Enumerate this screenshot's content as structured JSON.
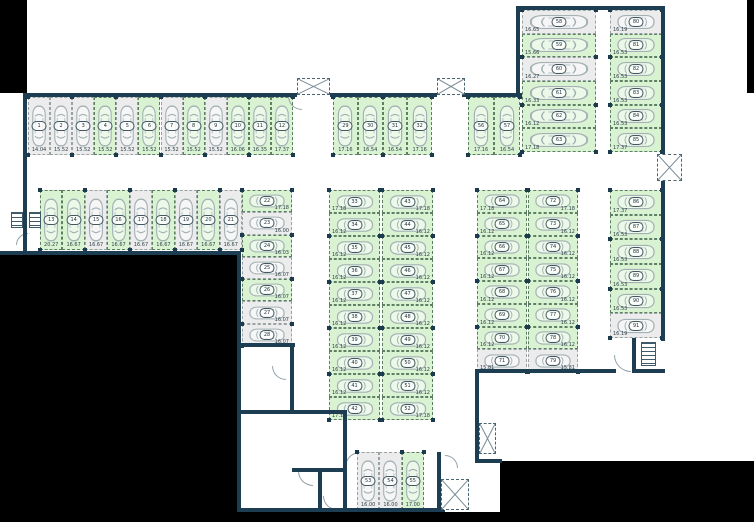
{
  "plan": {
    "name": "parking-garage-floor-plan",
    "colors": {
      "wall": "#1d3d52",
      "exterior": "#000000",
      "stall_free_fill": "#d9f2d2",
      "stall_free_border": "#5d7f63",
      "stall_occupied_fill": "#ececec",
      "stall_occupied_border": "#99a2a5",
      "car_outline": "#a3b1b4",
      "label_text": "#2e3f4a",
      "corner_marker": "#1c3a4e"
    },
    "groups": [
      {
        "id": "row-1-12",
        "dir": "row",
        "x": 28,
        "y": 97,
        "w": 265,
        "h": 58,
        "label": "bottom",
        "stalls": [
          {
            "n": "1",
            "m": "14.04",
            "s": "occ"
          },
          {
            "n": "2",
            "m": "15.52",
            "s": "occ"
          },
          {
            "n": "3",
            "m": "15.52",
            "s": "occ"
          },
          {
            "n": "4",
            "m": "15.52",
            "s": "free"
          },
          {
            "n": "5",
            "m": "15.52",
            "s": "occ"
          },
          {
            "n": "6",
            "m": "15.52",
            "s": "free"
          },
          {
            "n": "7",
            "m": "15.52",
            "s": "occ"
          },
          {
            "n": "8",
            "m": "15.52",
            "s": "free"
          },
          {
            "n": "9",
            "m": "15.52",
            "s": "occ"
          },
          {
            "n": "10",
            "m": "16.06",
            "s": "free"
          },
          {
            "n": "11",
            "m": "16.35",
            "s": "free"
          },
          {
            "n": "12",
            "m": "17.37",
            "s": "free"
          }
        ]
      },
      {
        "id": "row-13-21",
        "dir": "row",
        "x": 40,
        "y": 190,
        "w": 202,
        "h": 60,
        "label": "bottom",
        "stalls": [
          {
            "n": "13",
            "m": "20.27",
            "s": "free"
          },
          {
            "n": "14",
            "m": "16.67",
            "s": "free"
          },
          {
            "n": "15",
            "m": "16.67",
            "s": "occ"
          },
          {
            "n": "16",
            "m": "16.67",
            "s": "free"
          },
          {
            "n": "17",
            "m": "16.67",
            "s": "occ"
          },
          {
            "n": "18",
            "m": "16.67",
            "s": "free"
          },
          {
            "n": "19",
            "m": "16.67",
            "s": "occ"
          },
          {
            "n": "20",
            "m": "16.67",
            "s": "free"
          },
          {
            "n": "21",
            "m": "16.67",
            "s": "occ"
          }
        ]
      },
      {
        "id": "col-22-28",
        "dir": "col",
        "x": 242,
        "y": 190,
        "w": 50,
        "h": 156,
        "label": "right",
        "stalls": [
          {
            "n": "22",
            "m": "17.18",
            "s": "free"
          },
          {
            "n": "23",
            "m": "16.00",
            "s": "occ"
          },
          {
            "n": "24",
            "m": "16.03",
            "s": "free"
          },
          {
            "n": "25",
            "m": "16.07",
            "s": "occ"
          },
          {
            "n": "26",
            "m": "16.07",
            "s": "free"
          },
          {
            "n": "27",
            "m": "16.07",
            "s": "occ"
          },
          {
            "n": "28",
            "m": "16.07",
            "s": "occ"
          }
        ]
      },
      {
        "id": "row-29-32",
        "dir": "row",
        "x": 333,
        "y": 97,
        "w": 99,
        "h": 58,
        "label": "bottom",
        "stalls": [
          {
            "n": "29",
            "m": "17.16",
            "s": "free"
          },
          {
            "n": "30",
            "m": "16.54",
            "s": "free"
          },
          {
            "n": "31",
            "m": "16.54",
            "s": "free"
          },
          {
            "n": "32",
            "m": "17.16",
            "s": "free"
          }
        ]
      },
      {
        "id": "col-33-42",
        "dir": "col",
        "x": 329,
        "y": 190,
        "w": 51,
        "h": 230,
        "label": "left",
        "stalls": [
          {
            "n": "33",
            "m": "17.18",
            "s": "free"
          },
          {
            "n": "34",
            "m": "16.12",
            "s": "free"
          },
          {
            "n": "35",
            "m": "16.12",
            "s": "free"
          },
          {
            "n": "36",
            "m": "16.12",
            "s": "free"
          },
          {
            "n": "37",
            "m": "16.12",
            "s": "free"
          },
          {
            "n": "38",
            "m": "16.12",
            "s": "free"
          },
          {
            "n": "39",
            "m": "16.12",
            "s": "free"
          },
          {
            "n": "40",
            "m": "16.12",
            "s": "free"
          },
          {
            "n": "41",
            "m": "16.12",
            "s": "free"
          },
          {
            "n": "42",
            "m": "17.18",
            "s": "free"
          }
        ]
      },
      {
        "id": "col-43-52",
        "dir": "col",
        "x": 382,
        "y": 190,
        "w": 51,
        "h": 230,
        "label": "right",
        "stalls": [
          {
            "n": "43",
            "m": "17.18",
            "s": "free"
          },
          {
            "n": "44",
            "m": "16.12",
            "s": "free"
          },
          {
            "n": "45",
            "m": "16.12",
            "s": "free"
          },
          {
            "n": "46",
            "m": "16.12",
            "s": "free"
          },
          {
            "n": "47",
            "m": "16.12",
            "s": "free"
          },
          {
            "n": "48",
            "m": "16.12",
            "s": "free"
          },
          {
            "n": "49",
            "m": "16.12",
            "s": "free"
          },
          {
            "n": "50",
            "m": "16.12",
            "s": "free"
          },
          {
            "n": "51",
            "m": "16.12",
            "s": "free"
          },
          {
            "n": "52",
            "m": "17.18",
            "s": "free"
          }
        ]
      },
      {
        "id": "row-53-55",
        "dir": "row",
        "x": 357,
        "y": 452,
        "w": 67,
        "h": 58,
        "label": "bottom",
        "stalls": [
          {
            "n": "53",
            "m": "16.00",
            "s": "occ"
          },
          {
            "n": "54",
            "m": "16.00",
            "s": "occ"
          },
          {
            "n": "55",
            "m": "17.00",
            "s": "free"
          }
        ]
      },
      {
        "id": "row-56-57",
        "dir": "row",
        "x": 468,
        "y": 97,
        "w": 52,
        "h": 58,
        "label": "bottom",
        "stalls": [
          {
            "n": "56",
            "m": "17.16",
            "s": "free"
          },
          {
            "n": "57",
            "m": "16.54",
            "s": "free"
          }
        ]
      },
      {
        "id": "col-58-63",
        "dir": "col",
        "x": 522,
        "y": 10,
        "w": 74,
        "h": 142,
        "label": "left",
        "stalls": [
          {
            "n": "58",
            "m": "16.65",
            "s": "occ"
          },
          {
            "n": "59",
            "m": "15.66",
            "s": "free"
          },
          {
            "n": "60",
            "m": "16.27",
            "s": "occ"
          },
          {
            "n": "61",
            "m": "16.33",
            "s": "free"
          },
          {
            "n": "62",
            "m": "16.12",
            "s": "free"
          },
          {
            "n": "63",
            "m": "17.18",
            "s": "free"
          }
        ]
      },
      {
        "id": "col-80-85",
        "dir": "col",
        "x": 610,
        "y": 10,
        "w": 52,
        "h": 142,
        "label": "left",
        "stalls": [
          {
            "n": "80",
            "m": "16.19",
            "s": "occ"
          },
          {
            "n": "81",
            "m": "16.53",
            "s": "free"
          },
          {
            "n": "82",
            "m": "16.53",
            "s": "free"
          },
          {
            "n": "83",
            "m": "16.53",
            "s": "free"
          },
          {
            "n": "84",
            "m": "16.53",
            "s": "free"
          },
          {
            "n": "85",
            "m": "17.37",
            "s": "free"
          }
        ]
      },
      {
        "id": "col-64-71",
        "dir": "col",
        "x": 477,
        "y": 190,
        "w": 50,
        "h": 182,
        "label": "left",
        "stalls": [
          {
            "n": "64",
            "m": "17.18",
            "s": "free"
          },
          {
            "n": "65",
            "m": "16.12",
            "s": "free"
          },
          {
            "n": "66",
            "m": "16.12",
            "s": "free"
          },
          {
            "n": "67",
            "m": "16.12",
            "s": "free"
          },
          {
            "n": "68",
            "m": "16.12",
            "s": "free"
          },
          {
            "n": "69",
            "m": "16.12",
            "s": "free"
          },
          {
            "n": "70",
            "m": "16.12",
            "s": "free"
          },
          {
            "n": "71",
            "m": "15.81",
            "s": "occ"
          }
        ]
      },
      {
        "id": "col-72-79",
        "dir": "col",
        "x": 528,
        "y": 190,
        "w": 50,
        "h": 182,
        "label": "right",
        "stalls": [
          {
            "n": "72",
            "m": "17.18",
            "s": "free"
          },
          {
            "n": "73",
            "m": "16.12",
            "s": "free"
          },
          {
            "n": "74",
            "m": "16.12",
            "s": "free"
          },
          {
            "n": "75",
            "m": "16.12",
            "s": "free"
          },
          {
            "n": "76",
            "m": "16.12",
            "s": "free"
          },
          {
            "n": "77",
            "m": "16.12",
            "s": "free"
          },
          {
            "n": "78",
            "m": "16.12",
            "s": "free"
          },
          {
            "n": "79",
            "m": "15.81",
            "s": "occ"
          }
        ]
      },
      {
        "id": "col-86-91",
        "dir": "col",
        "x": 610,
        "y": 190,
        "w": 52,
        "h": 148,
        "label": "left",
        "stalls": [
          {
            "n": "86",
            "m": "17.37",
            "s": "free"
          },
          {
            "n": "87",
            "m": "16.53",
            "s": "free"
          },
          {
            "n": "88",
            "m": "16.53",
            "s": "free"
          },
          {
            "n": "89",
            "m": "16.53",
            "s": "free"
          },
          {
            "n": "90",
            "m": "16.53",
            "s": "free"
          },
          {
            "n": "91",
            "m": "16.19",
            "s": "occ"
          }
        ]
      }
    ],
    "features": {
      "exterior": [
        [
          0,
          0,
          27,
          93
        ],
        [
          747,
          0,
          7,
          93
        ],
        [
          0,
          253,
          237,
          269
        ],
        [
          237,
          512,
          517,
          10
        ],
        [
          500,
          461,
          254,
          61
        ]
      ],
      "walls": [
        [
          27,
          93,
          270,
          4
        ],
        [
          330,
          93,
          107,
          4
        ],
        [
          462,
          93,
          60,
          4
        ],
        [
          23,
          93,
          4,
          162
        ],
        [
          0,
          251,
          241,
          4
        ],
        [
          237,
          251,
          4,
          261
        ],
        [
          237,
          508,
          208,
          4
        ],
        [
          437,
          452,
          4,
          58
        ],
        [
          237,
          343,
          58,
          4
        ],
        [
          290,
          345,
          4,
          68
        ],
        [
          237,
          410,
          110,
          4
        ],
        [
          343,
          410,
          4,
          100
        ],
        [
          318,
          468,
          4,
          42
        ],
        [
          292,
          468,
          54,
          4
        ],
        [
          516,
          6,
          4,
          90
        ],
        [
          516,
          6,
          149,
          4
        ],
        [
          661,
          6,
          4,
          151
        ],
        [
          661,
          180,
          4,
          161
        ],
        [
          632,
          338,
          4,
          34
        ],
        [
          632,
          369,
          33,
          4
        ],
        [
          475,
          369,
          141,
          4
        ],
        [
          475,
          369,
          4,
          94
        ],
        [
          475,
          459,
          27,
          4
        ]
      ],
      "vents": [
        [
          297,
          78,
          33,
          17
        ],
        [
          437,
          78,
          28,
          17
        ],
        [
          657,
          154,
          25,
          27
        ],
        [
          479,
          423,
          17,
          31
        ],
        [
          441,
          479,
          28,
          31
        ]
      ],
      "stairs": [
        [
          11,
          212,
          12,
          16
        ],
        [
          29,
          212,
          12,
          16
        ],
        [
          641,
          342,
          15,
          24
        ]
      ],
      "doors": [
        {
          "x": 288,
          "y": 96,
          "r": 13,
          "rot": 0
        },
        {
          "x": 16,
          "y": 233,
          "r": 11,
          "rot": 90
        },
        {
          "x": 272,
          "y": 366,
          "r": 13,
          "rot": 0
        },
        {
          "x": 298,
          "y": 471,
          "r": 14,
          "rot": 0
        },
        {
          "x": 345,
          "y": 452,
          "r": 14,
          "rot": 90
        },
        {
          "x": 323,
          "y": 496,
          "r": 13,
          "rot": 0
        },
        {
          "x": 614,
          "y": 355,
          "r": 16,
          "rot": 0
        },
        {
          "x": 445,
          "y": 455,
          "r": 12,
          "rot": 180
        }
      ]
    }
  }
}
